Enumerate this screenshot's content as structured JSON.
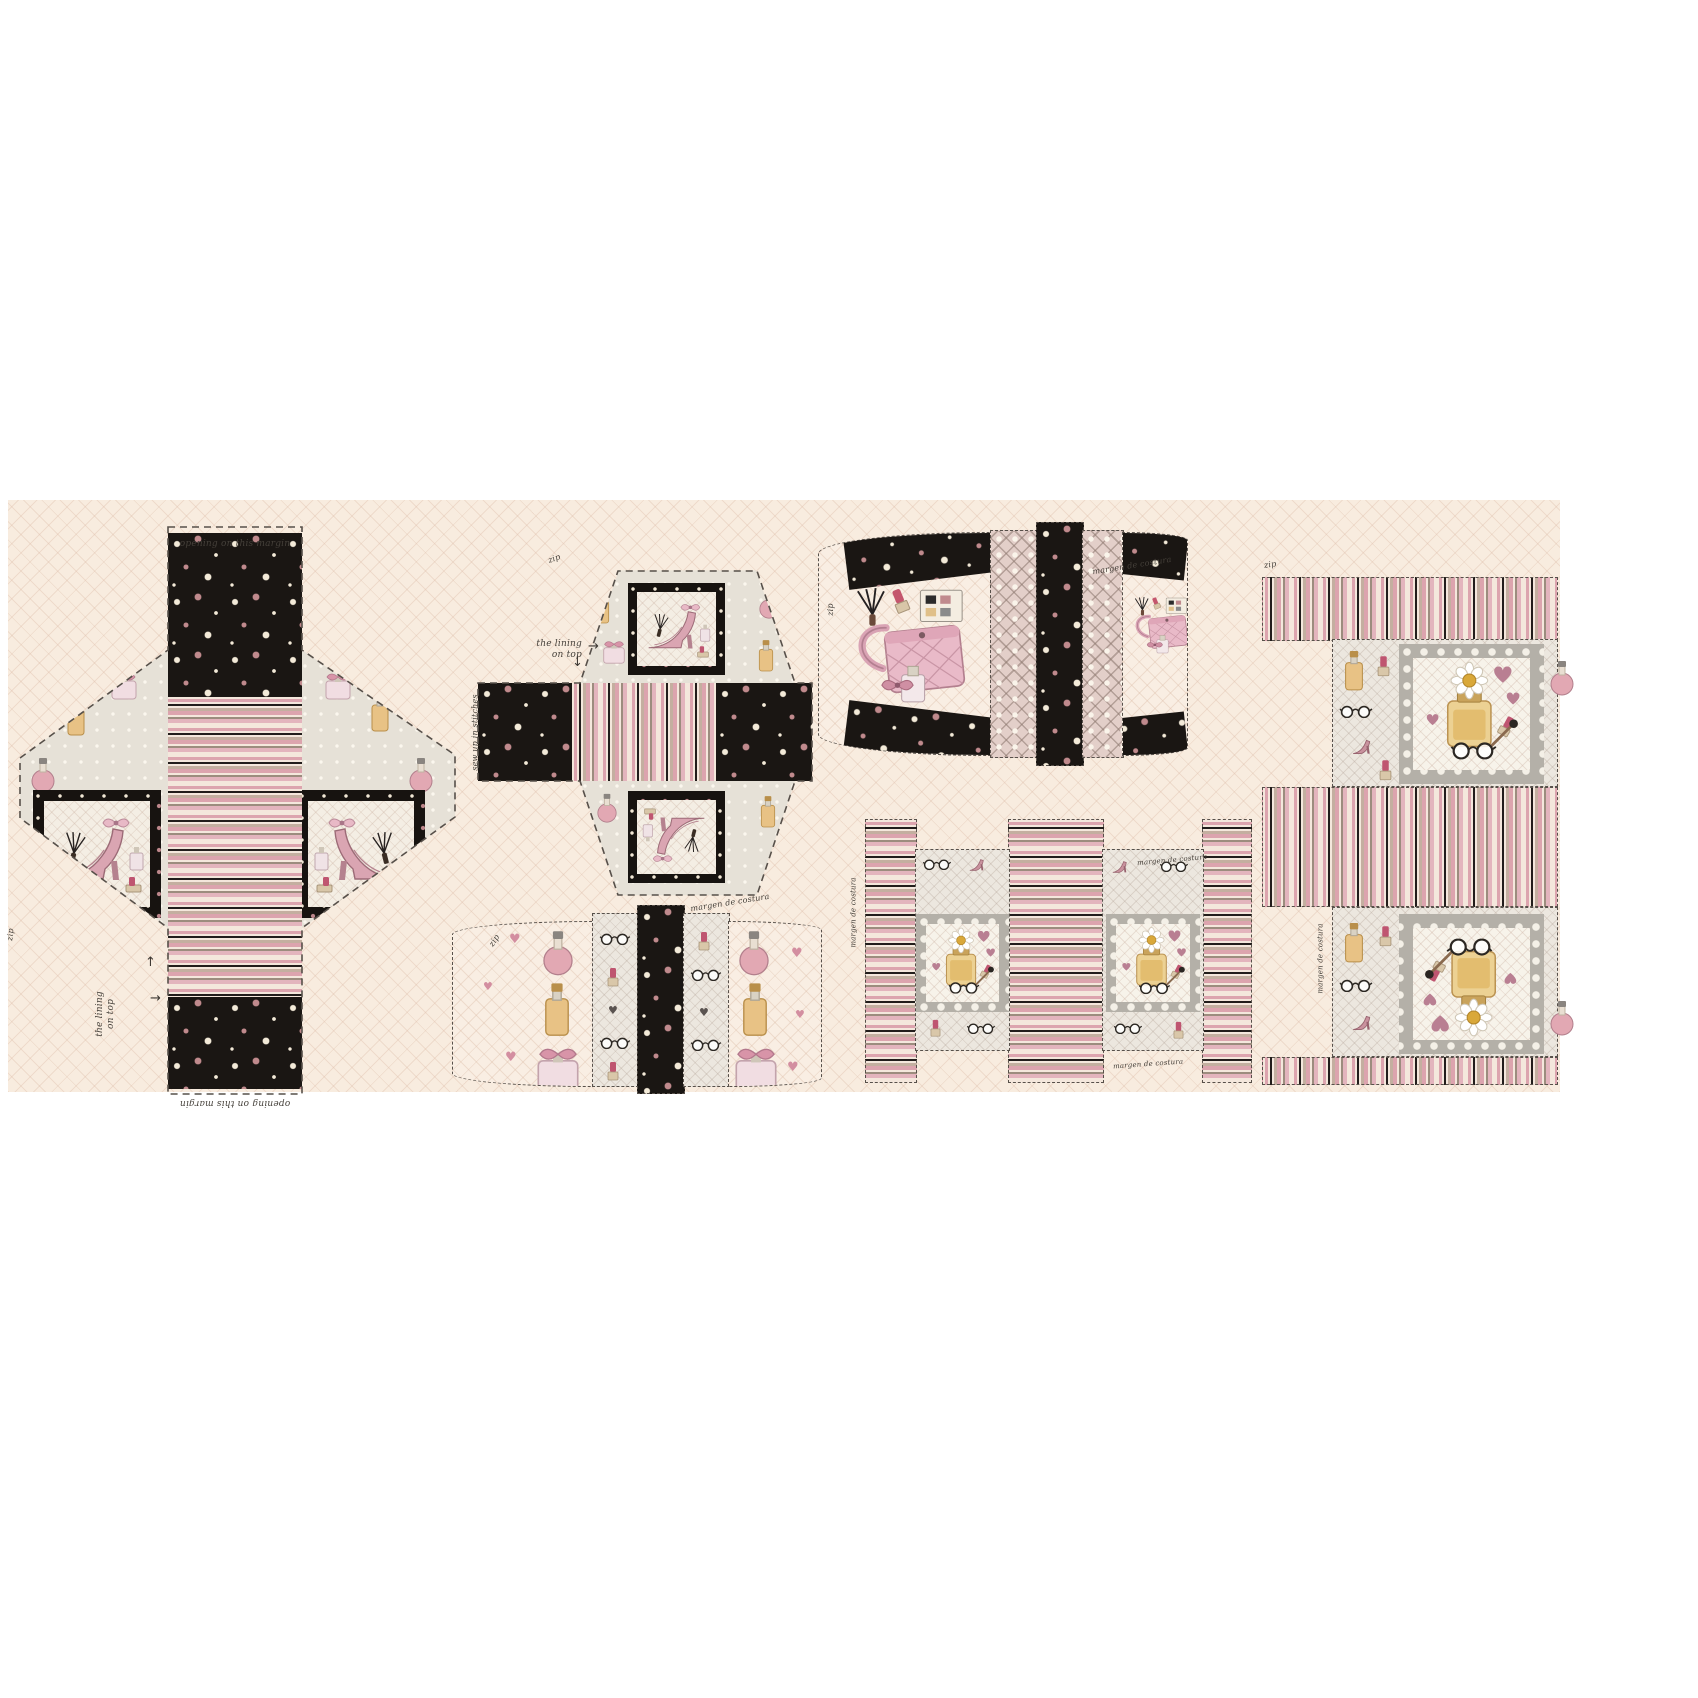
{
  "panel": {
    "annotations": {
      "seam_allowance": "margen de costura",
      "lining_line1": "the lining",
      "lining_line2": "on top",
      "opening_note": "opening on this margin",
      "zip_mark": "zip",
      "stitch_note": "sew up in stitches",
      "arrow_up": "↑",
      "arrow_right": "→",
      "arrow_down": "↓"
    },
    "colors": {
      "page_bg": "#ffffff",
      "panel_cream": "#f8ecdf",
      "lattice_line": "#e8d3c3",
      "pattern_black": "#1a1613",
      "dot_white": "#f3ead8",
      "dot_rose": "#c08a8d",
      "stripe_pink": "#dca4ae",
      "stripe_taupe": "#b3a294",
      "print_grey": "#e6e1d7",
      "frame_grey": "#b4b0a8",
      "accent_rose": "#d494a6",
      "amber": "#e8c285"
    },
    "motifs": [
      "perfume-bottle",
      "high-heel-shoe",
      "handbag",
      "cat-eye-glasses",
      "lipstick",
      "fan-brush",
      "daisy",
      "heart",
      "bow",
      "polka-dots",
      "stripes"
    ]
  }
}
